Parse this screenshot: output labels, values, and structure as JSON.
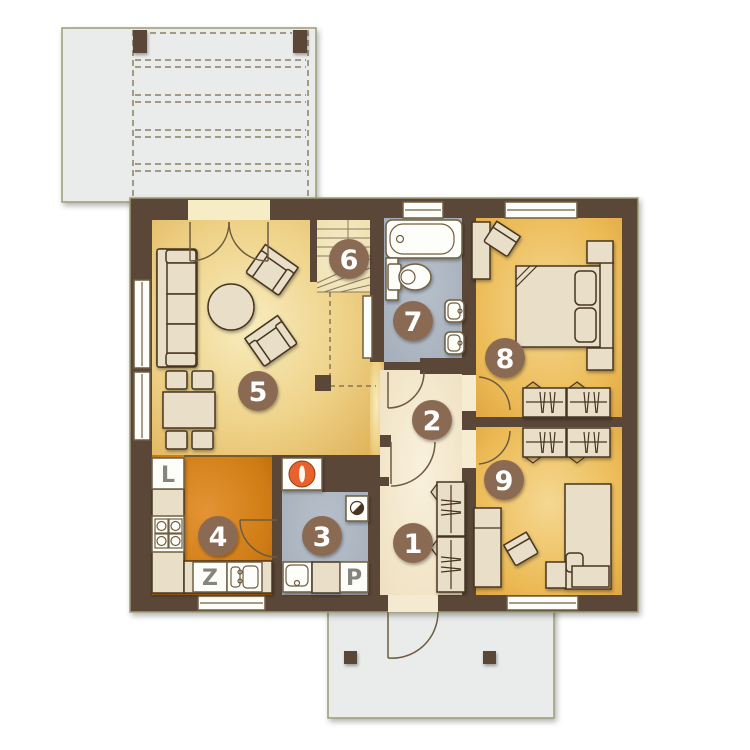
{
  "badges": [
    {
      "label": "1"
    },
    {
      "label": "2"
    },
    {
      "label": "3"
    },
    {
      "label": "4"
    },
    {
      "label": "5"
    },
    {
      "label": "6"
    },
    {
      "label": "7"
    },
    {
      "label": "8"
    },
    {
      "label": "9"
    }
  ],
  "appliances": {
    "fridge": "L",
    "dishwasher": "Z",
    "washer": "P"
  },
  "colors": {
    "wall": "#5a4738",
    "outline": "#9b9b74",
    "badge": "#8a6b52",
    "boiler": "#e8622d",
    "living_floor": "#f0d98f",
    "kitchen_floor": "#d5831e",
    "bedroom_floor": "#efc570",
    "bath_floor": "#adb7c2",
    "hall_floor": "#f6ecd2",
    "terrace": "#eaeceb",
    "furniture": "#e9dfc8"
  }
}
